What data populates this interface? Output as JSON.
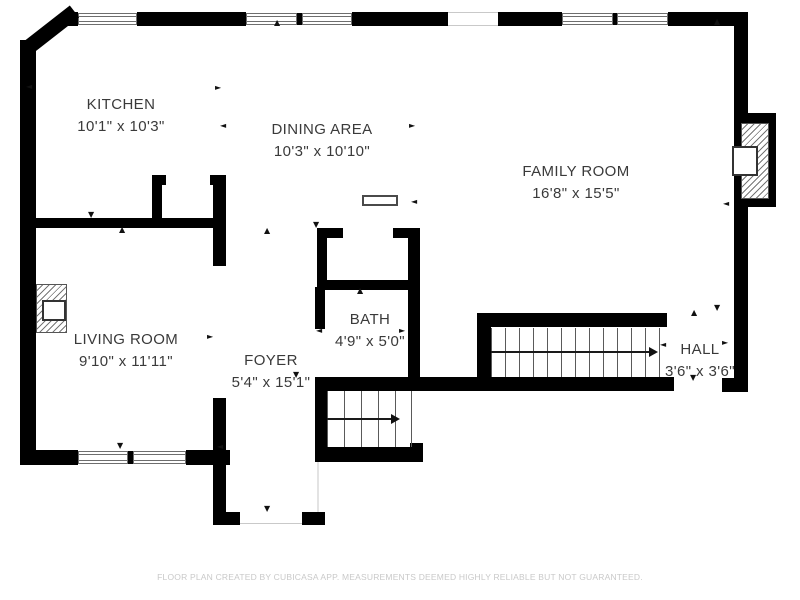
{
  "meta": {
    "footer": "FLOOR PLAN CREATED BY CUBICASA APP. MEASUREMENTS DEEMED HIGHLY RELIABLE BUT NOT GUARANTEED."
  },
  "colors": {
    "wall": "#000000",
    "background": "#ffffff",
    "label_text": "#3a3a3a",
    "footer_text": "#c9c9c9",
    "stair_line": "#5a5a5a"
  },
  "rooms": {
    "kitchen": {
      "name": "KITCHEN",
      "dims": "10'1\" x 10'3\""
    },
    "dining": {
      "name": "DINING AREA",
      "dims": "10'3\" x 10'10\""
    },
    "family": {
      "name": "FAMILY ROOM",
      "dims": "16'8\" x 15'5\""
    },
    "living": {
      "name": "LIVING ROOM",
      "dims": "9'10\" x 11'11\""
    },
    "foyer": {
      "name": "FOYER",
      "dims": "5'4\" x 15'1\""
    },
    "bath": {
      "name": "BATH",
      "dims": "4'9\" x 5'0\""
    },
    "hall": {
      "name": "HALL",
      "dims": "3'6\" x 3'6\""
    }
  },
  "icons": {
    "up": "▲",
    "down": "▼",
    "left": "◄",
    "right": "►"
  }
}
